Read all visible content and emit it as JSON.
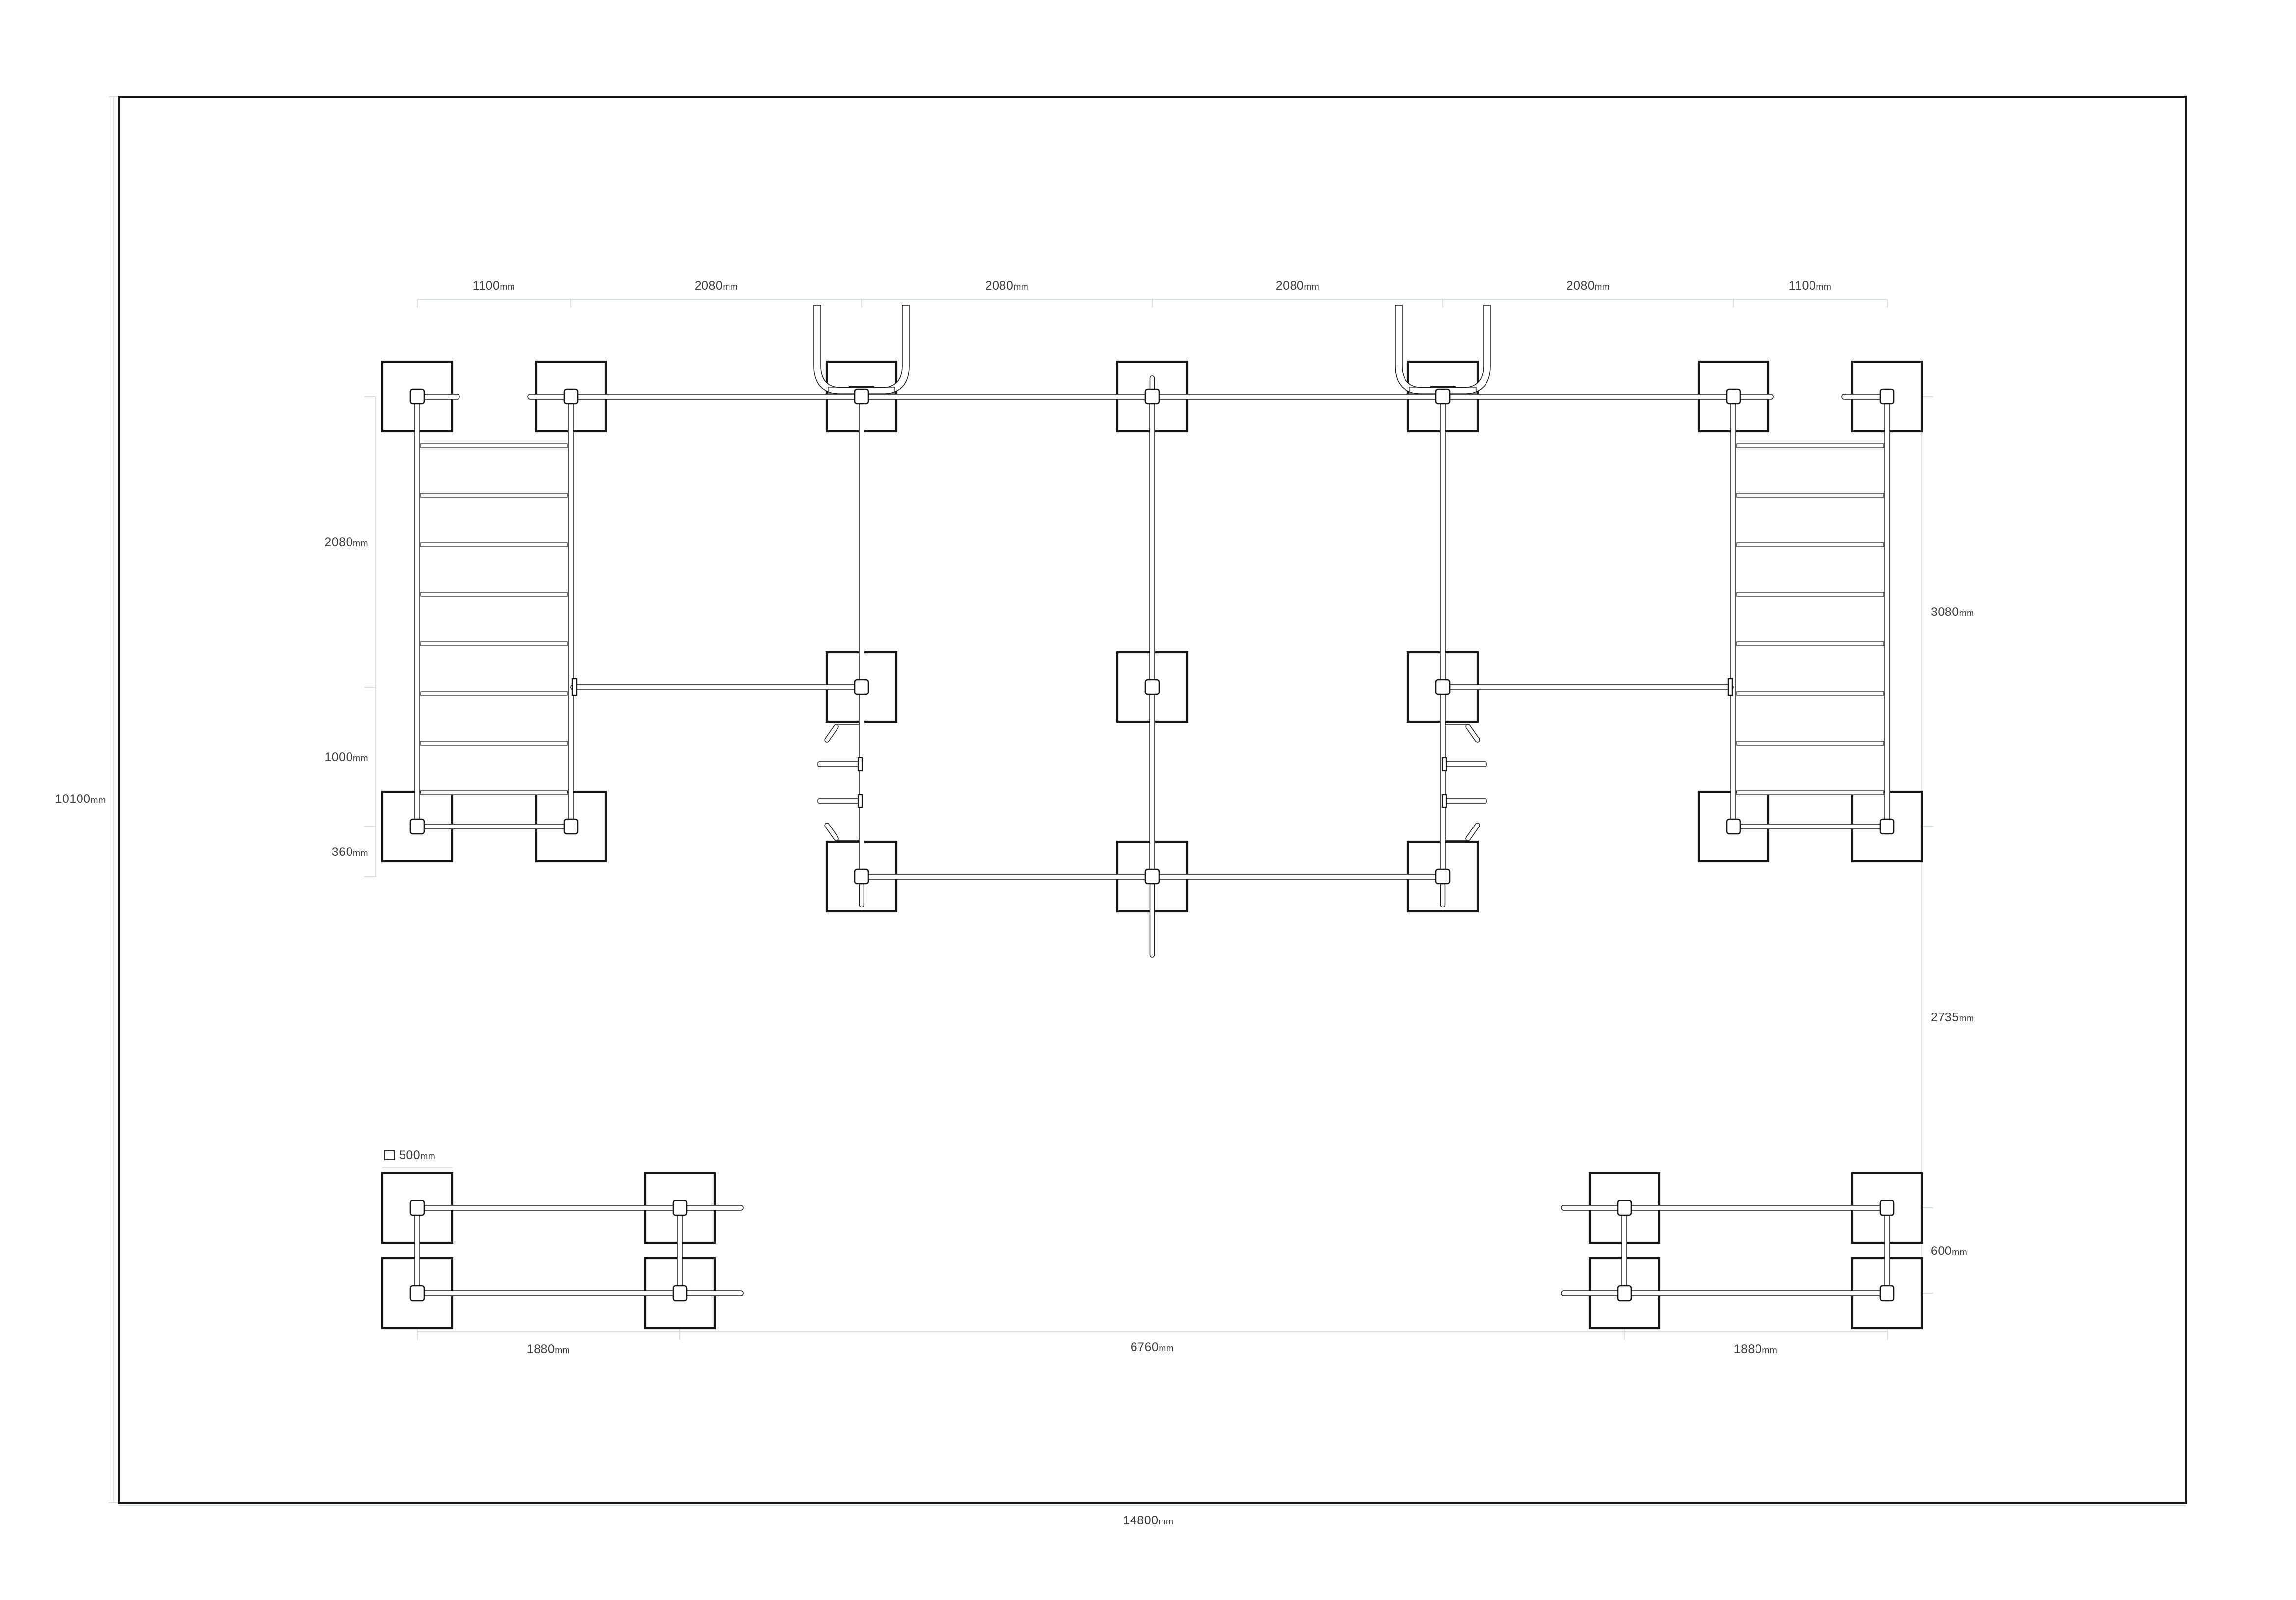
{
  "drawing": {
    "title": "playground-structure-plan",
    "unit": "mm",
    "colors": {
      "line": "#161616",
      "dim_line": "#ccd3d3",
      "label": "#3a3a3a",
      "background": "#ffffff"
    },
    "legend": {
      "v": "500",
      "u": "mm"
    },
    "dims": {
      "top": [
        {
          "v": "1100",
          "u": "mm"
        },
        {
          "v": "2080",
          "u": "mm"
        },
        {
          "v": "2080",
          "u": "mm"
        },
        {
          "v": "2080",
          "u": "mm"
        },
        {
          "v": "2080",
          "u": "mm"
        },
        {
          "v": "1100",
          "u": "mm"
        }
      ],
      "left_chain": [
        {
          "v": "2080",
          "u": "mm"
        },
        {
          "v": "1000",
          "u": "mm"
        },
        {
          "v": "360",
          "u": "mm"
        }
      ],
      "right_chain": [
        {
          "v": "3080",
          "u": "mm"
        },
        {
          "v": "2735",
          "u": "mm"
        },
        {
          "v": "600",
          "u": "mm"
        }
      ],
      "bottom_chain": [
        {
          "v": "1880",
          "u": "mm"
        },
        {
          "v": "6760",
          "u": "mm"
        },
        {
          "v": "1880",
          "u": "mm"
        }
      ],
      "width": {
        "v": "14800",
        "u": "mm"
      },
      "height": {
        "v": "10100",
        "u": "mm"
      }
    }
  }
}
